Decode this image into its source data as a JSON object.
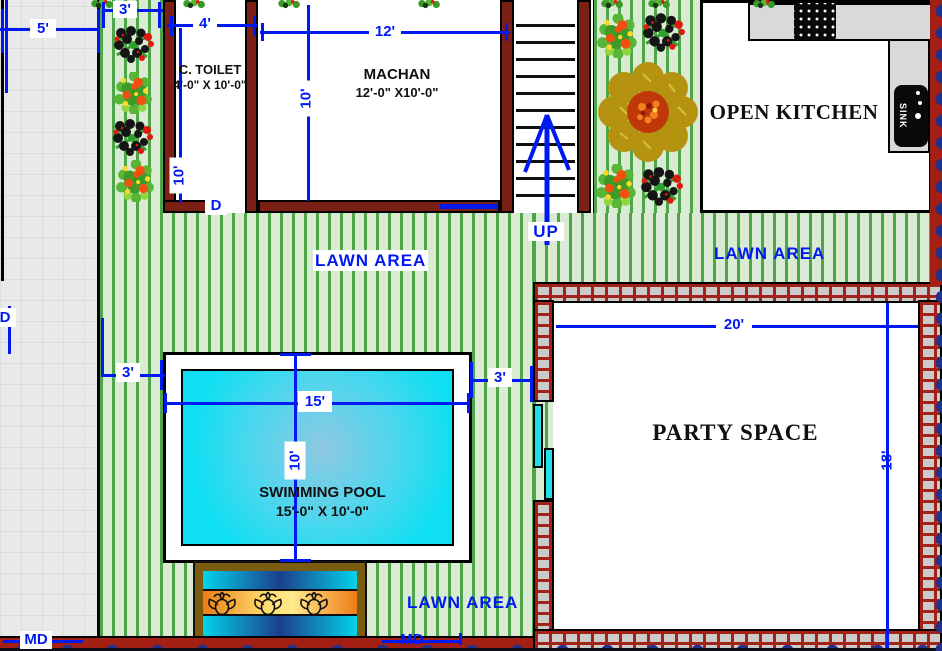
{
  "rooms": {
    "toilet": {
      "name": "C. TOILET",
      "size": "4'-0\" X 10'-0\""
    },
    "machan": {
      "name": "MACHAN",
      "size": "12'-0\" X10'-0\""
    },
    "kitchen": {
      "name": "OPEN KITCHEN"
    },
    "party": {
      "name": "PARTY SPACE"
    },
    "pool": {
      "name": "SWIMMING POOL",
      "size": "15'-0\" X 10'-0\""
    }
  },
  "areas": {
    "lawn_top": "LAWN AREA",
    "lawn_right": "LAWN AREA",
    "lawn_bottom": "LAWN AREA"
  },
  "dimensions": {
    "walkway": "5'",
    "planter": "3'",
    "toilet_w": "4'",
    "machan_w": "12'",
    "machan_d": "10'",
    "toilet_d": "10'",
    "pool_l": "15'",
    "pool_d": "10'",
    "pool_off_l": "3'",
    "pool_off_r": "3'",
    "party_w": "20'",
    "party_d": "18'"
  },
  "annotations": {
    "up": "UP",
    "sink": "SINK",
    "door_toilet": "D",
    "door_left": "D",
    "md_left": "MD",
    "md_right": "MD"
  },
  "colors": {
    "dim_blue": "#0019f0",
    "wall_maroon": "#7c2016",
    "brick_red": "#a22217",
    "lawn_green": "#4fa549",
    "pool_cyan": "#12dff2",
    "counter_gray": "#d9d9d9",
    "boundary_red": "#a21f14",
    "scallop_navy": "#24308a"
  },
  "icons": [
    "grill-icon",
    "sink-icon",
    "stairs-up-arrow-icon",
    "lotus-icon",
    "big-tree-icon",
    "flower-bush-icon",
    "berry-bush-icon",
    "leaf-top-icon"
  ]
}
